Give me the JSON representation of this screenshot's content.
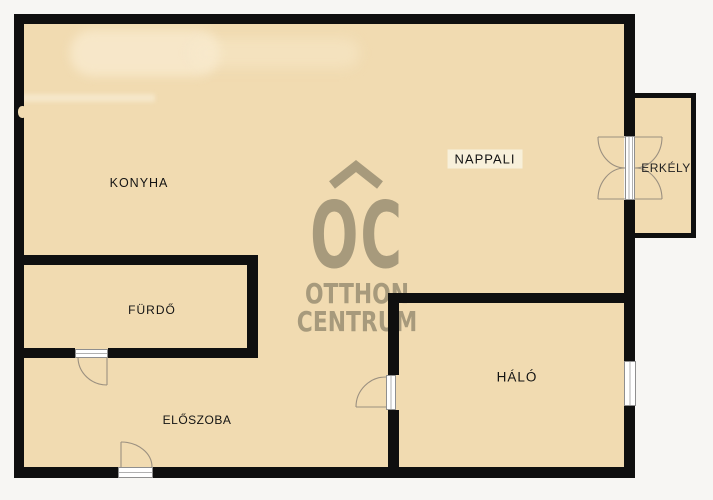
{
  "plan_title": "floor-plan",
  "rooms": [
    {
      "id": "konyha",
      "label": "KONYHA"
    },
    {
      "id": "nappali",
      "label": "NAPPALI"
    },
    {
      "id": "erkely",
      "label": "ERKÉLY"
    },
    {
      "id": "furdo",
      "label": "FÜRDŐ"
    },
    {
      "id": "eloszoba",
      "label": "ELŐSZOBA"
    },
    {
      "id": "halo",
      "label": "HÁLÓ"
    }
  ],
  "watermark": {
    "logo": "OC",
    "brand_line1": "OTTHON",
    "brand_line2": "CENTRUM"
  },
  "colors": {
    "floor": "#f1dbb1",
    "wall": "#0f0f0f",
    "outside": "#f7f6f3",
    "watermark": "#a79a7c",
    "label": "#131313",
    "hl": "#f8f0da",
    "open-fill": "#ffffff",
    "open-border": "#8f8f8f",
    "swing": "#9b9080"
  }
}
